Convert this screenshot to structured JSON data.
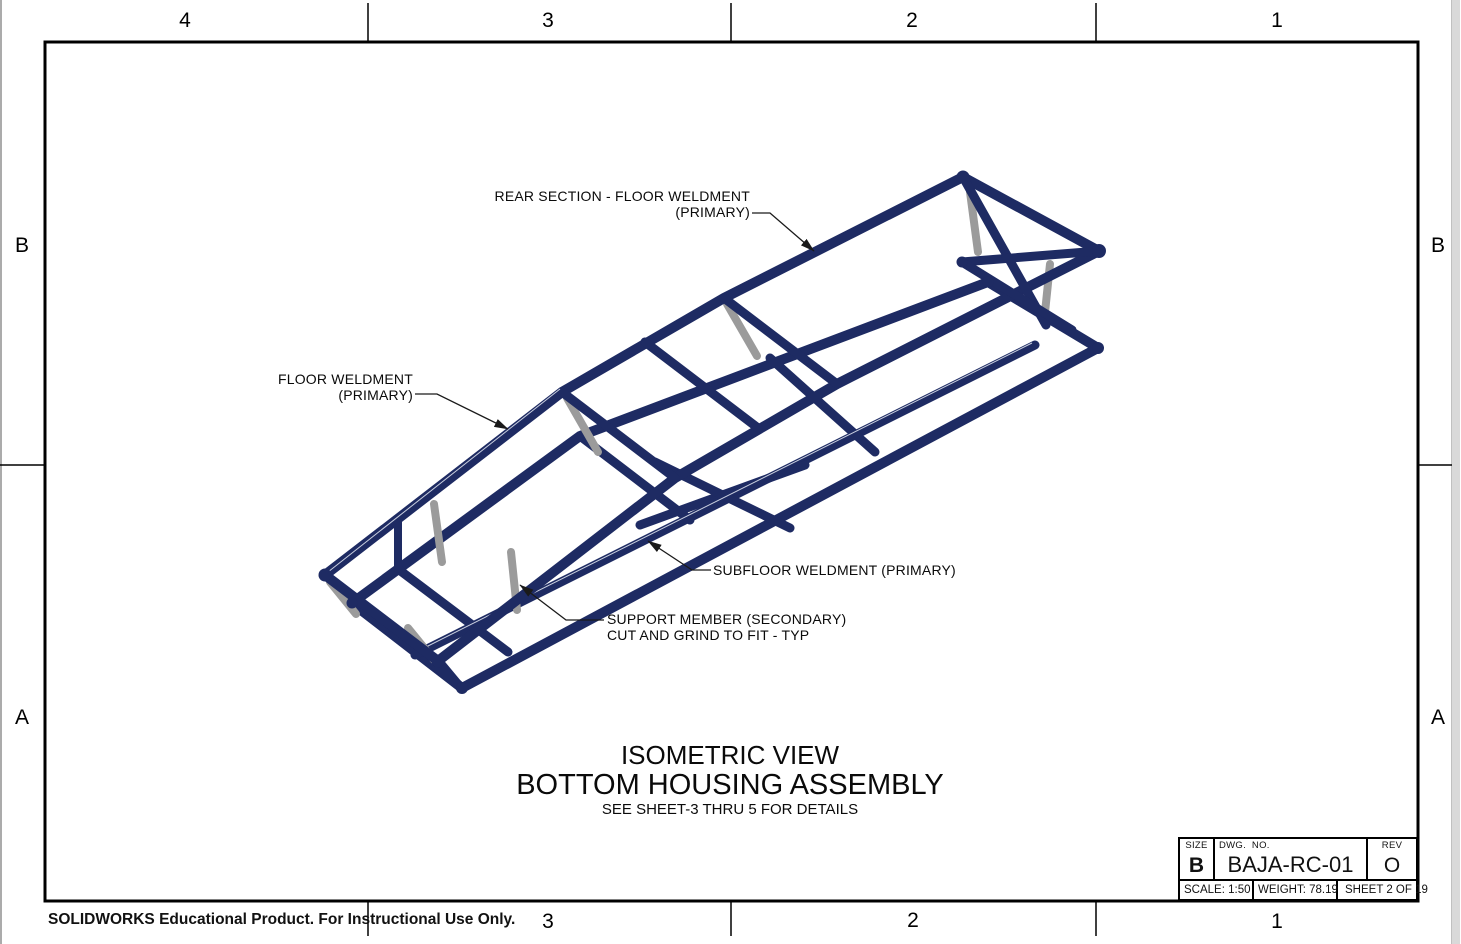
{
  "zones": {
    "top": [
      "4",
      "3",
      "2",
      "1"
    ],
    "bottom": [
      "3",
      "2",
      "1"
    ],
    "left": [
      "B",
      "A"
    ],
    "right": [
      "B",
      "A"
    ]
  },
  "callouts": {
    "rear_section_line1": "REAR SECTION - FLOOR WELDMENT",
    "rear_section_line2": "(PRIMARY)",
    "floor_line1": "FLOOR WELDMENT",
    "floor_line2": "(PRIMARY)",
    "subfloor": "SUBFLOOR WELDMENT (PRIMARY)",
    "support_line1": "SUPPORT MEMBER (SECONDARY)",
    "support_line2": "CUT AND GRIND TO FIT - TYP"
  },
  "view_title": {
    "primary": "ISOMETRIC VIEW",
    "secondary": "BOTTOM HOUSING ASSEMBLY",
    "note": "SEE SHEET-3 THRU 5 FOR DETAILS"
  },
  "title_block": {
    "size_label": "SIZE",
    "size_value": "B",
    "dwg_no_label": "DWG.  NO.",
    "dwg_no_value": "BAJA-RC-01",
    "rev_label": "REV",
    "rev_value": "O",
    "scale": "SCALE: 1:50",
    "weight": "WEIGHT: 78.19",
    "sheet": "SHEET 2 OF 19"
  },
  "footer": {
    "notice": "SOLIDWORKS Educational Product. For Instructional Use Only."
  },
  "colors": {
    "tube": "#1e2b63",
    "strut": "#9b9b9b",
    "line": "#000000",
    "leader": "#1a1a1a"
  }
}
